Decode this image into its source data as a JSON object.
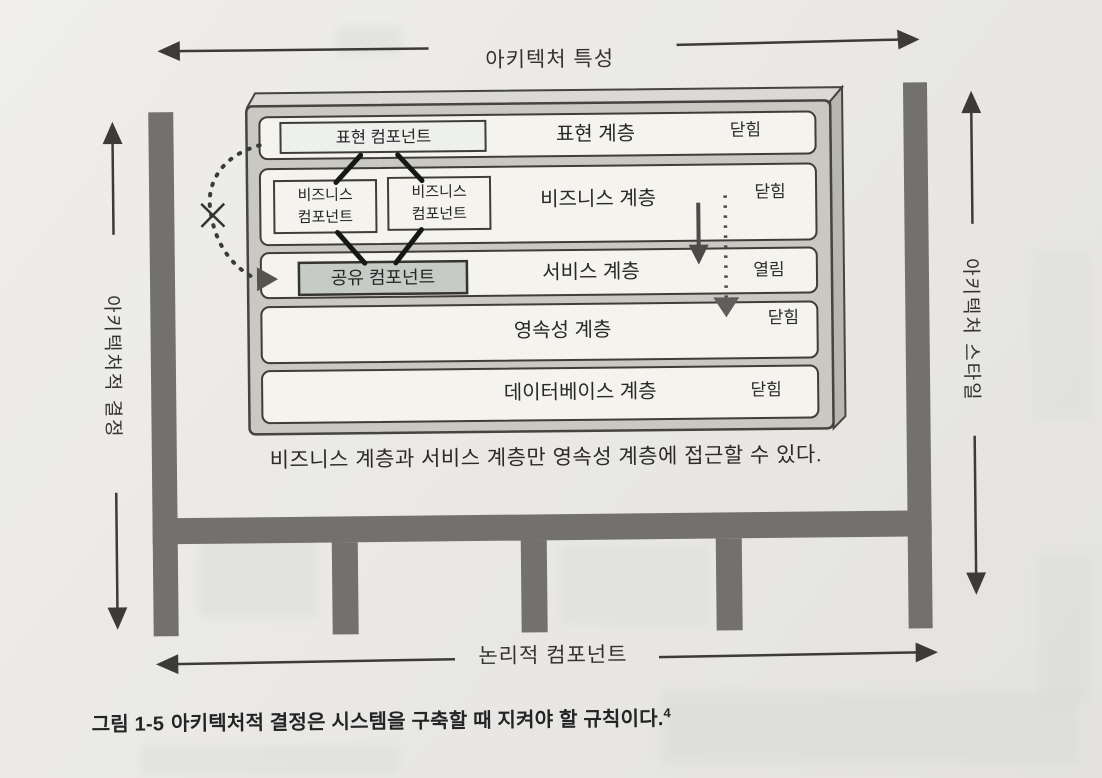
{
  "axes": {
    "top": {
      "label": "아키텍처 특성"
    },
    "bottom": {
      "label": "논리적 컴포넌트"
    },
    "left": {
      "label": "아키텍처적 결정"
    },
    "right": {
      "label": "아키텍처 스타일"
    }
  },
  "diagram": {
    "layers": [
      {
        "name": "표현 계층",
        "state": "닫힘"
      },
      {
        "name": "비즈니스 계층",
        "state": "닫힘"
      },
      {
        "name": "서비스 계층",
        "state": "열림"
      },
      {
        "name": "영속성 계층",
        "state": "닫힘"
      },
      {
        "name": "데이터베이스 계층",
        "state": "닫힘"
      }
    ],
    "components": {
      "presentation": {
        "label": "표현 컴포넌트"
      },
      "business1": {
        "line1": "비즈니스",
        "line2": "컴포넌트"
      },
      "business2": {
        "line1": "비즈니스",
        "line2": "컴포넌트"
      },
      "shared": {
        "label": "공유 컴포넌트"
      }
    },
    "note": "비즈니스 계층과 서비스 계층만 영속성 계층에 접근할 수 있다."
  },
  "caption": {
    "figure_label": "그림 1-5",
    "text": "아키텍처적 결정은 시스템을 구축할 때 지켜야 할 규칙이다.",
    "footnote_marker": "4"
  },
  "colors": {
    "page_background": "#eae9e5",
    "wall": "#73716e",
    "container_fill": "#c9c8c3",
    "container_top": "#dad9d5",
    "container_side": "#b7b6b1",
    "layer_fill": "#f4f3ee",
    "shared_component_fill": "#c7cbc5",
    "line": "#3c3b38",
    "text": "#2e2d2a"
  }
}
